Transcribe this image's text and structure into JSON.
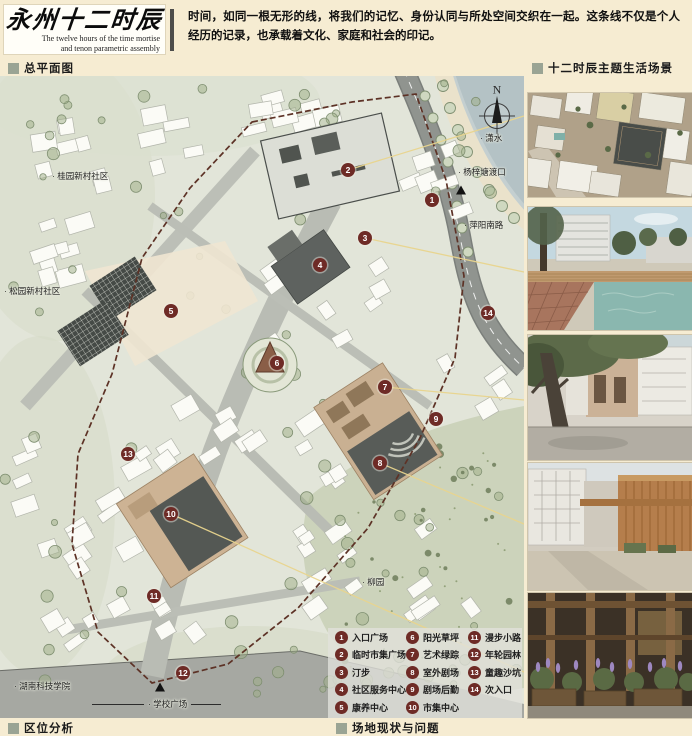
{
  "header": {
    "title_cn": "永州十二时辰",
    "title_en_line1": "The twelve hours of the time mortise",
    "title_en_line2": "and tenon parametric assembly",
    "intro": "时间，如同一根无形的线，将我们的记忆、身份认同与所处空间交织在一起。这条线不仅是个人经历的记录，也承载着文化、家庭和社会的印记。"
  },
  "sections": {
    "master_plan": "总平面图",
    "scenes": "十二时辰主题生活场景",
    "location": "区位分析",
    "site": "场地现状与问题"
  },
  "map": {
    "compass": "N",
    "labels": [
      {
        "text": "· 桂园新村社区",
        "x": 52,
        "y": 100
      },
      {
        "text": "· 松园新村社区",
        "x": 4,
        "y": 215
      },
      {
        "text": "· 潇水",
        "x": 480,
        "y": 62
      },
      {
        "text": "· 杨梓塘渡口",
        "x": 458,
        "y": 96
      },
      {
        "text": "· 萍阳南路",
        "x": 464,
        "y": 149
      },
      {
        "text": "· 柳园",
        "x": 362,
        "y": 506
      },
      {
        "text": "· 湖南科技学院",
        "x": 14,
        "y": 610
      },
      {
        "text": "· 学校广场",
        "x": 92,
        "y": 628,
        "rule": true
      }
    ],
    "markers": [
      {
        "n": "1",
        "x": 432,
        "y": 124
      },
      {
        "n": "2",
        "x": 348,
        "y": 94
      },
      {
        "n": "3",
        "x": 365,
        "y": 162
      },
      {
        "n": "4",
        "x": 320,
        "y": 189
      },
      {
        "n": "5",
        "x": 171,
        "y": 235
      },
      {
        "n": "6",
        "x": 277,
        "y": 287
      },
      {
        "n": "7",
        "x": 385,
        "y": 311
      },
      {
        "n": "8",
        "x": 380,
        "y": 387
      },
      {
        "n": "9",
        "x": 436,
        "y": 343
      },
      {
        "n": "10",
        "x": 171,
        "y": 438
      },
      {
        "n": "11",
        "x": 154,
        "y": 520
      },
      {
        "n": "12",
        "x": 183,
        "y": 597
      },
      {
        "n": "13",
        "x": 128,
        "y": 378
      },
      {
        "n": "14",
        "x": 488,
        "y": 237
      }
    ],
    "triangles": [
      {
        "x": 461,
        "y": 114
      },
      {
        "x": 160,
        "y": 611
      }
    ]
  },
  "legend": {
    "items": [
      {
        "n": "1",
        "label": "入口广场"
      },
      {
        "n": "2",
        "label": "临时市集广场"
      },
      {
        "n": "3",
        "label": "汀步"
      },
      {
        "n": "4",
        "label": "社区服务中心"
      },
      {
        "n": "5",
        "label": "康养中心"
      },
      {
        "n": "6",
        "label": "阳光草坪"
      },
      {
        "n": "7",
        "label": "艺术绿踪"
      },
      {
        "n": "8",
        "label": "室外剧场"
      },
      {
        "n": "9",
        "label": "剧场后勤"
      },
      {
        "n": "10",
        "label": "市集中心"
      },
      {
        "n": "11",
        "label": "漫步小路"
      },
      {
        "n": "12",
        "label": "年轮园林"
      },
      {
        "n": "13",
        "label": "童趣沙坑"
      },
      {
        "n": "14",
        "label": "次入口"
      }
    ]
  },
  "colors": {
    "background": "#f6ecd2",
    "marker": "#6e2b26",
    "section_bullet": "#9aa494",
    "leader_line": "#e9d58e",
    "boundary": "#5d3226"
  }
}
